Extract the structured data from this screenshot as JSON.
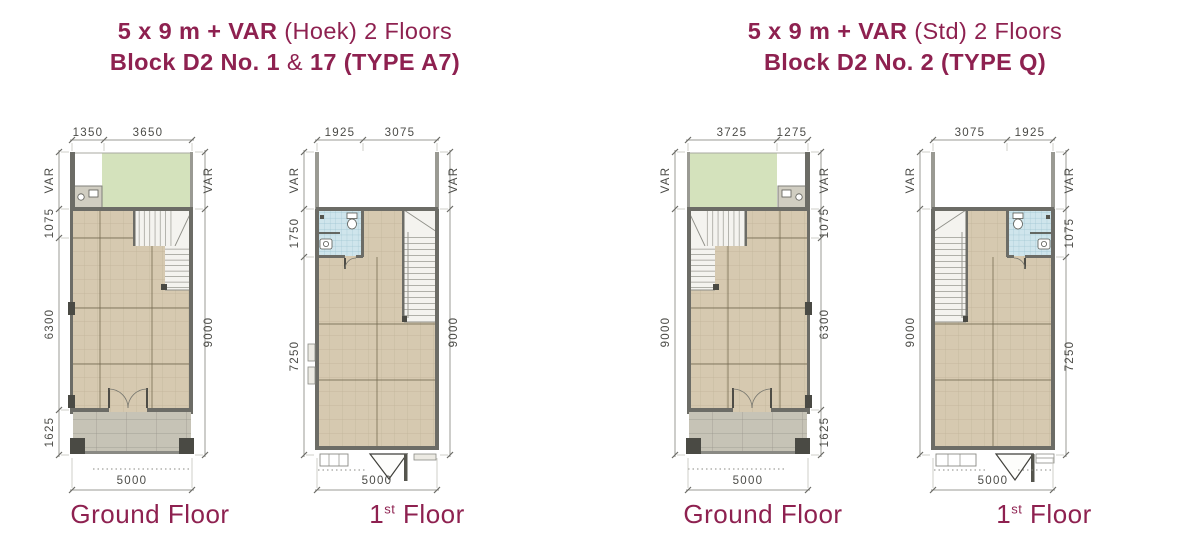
{
  "colors": {
    "accent_maroon": "#8e2150",
    "dim_text": "#4b4b47",
    "dim_line": "#9b9b95",
    "garden_green": "#d4e2bc",
    "floor_tan": "#d6c9b0",
    "porch_gray": "#c6c3b6",
    "wall_dark": "#6c6c66",
    "bath_blue": "#cfe5ec",
    "stair_white": "#f4f3ef"
  },
  "titles": [
    {
      "line1_bold": "5 x 9 m + VAR",
      "line1_regular": " (Hoek) 2 Floors",
      "line2_part1": "Block D2 No. 1",
      "line2_amp": " & ",
      "line2_part2": "17 (TYPE A7)"
    },
    {
      "line1_bold": "5 x 9 m + VAR",
      "line1_regular": " (Std) 2 Floors",
      "line2": "Block D2 No. 2 (TYPE Q)"
    }
  ],
  "plans": [
    {
      "label": "Ground Floor",
      "top_dims": [
        "1350",
        "3650"
      ],
      "left_dims": [
        "VAR",
        "1075",
        "6300",
        "1625"
      ],
      "right_dims": [
        "VAR",
        "9000"
      ],
      "bottom_dim": "5000"
    },
    {
      "label_num": "1",
      "label_sup": "st",
      "label_rest": " Floor",
      "top_dims": [
        "1925",
        "3075"
      ],
      "left_dims": [
        "VAR",
        "1750",
        "7250"
      ],
      "right_dims": [
        "VAR",
        "9000"
      ],
      "bottom_dim": "5000"
    },
    {
      "label": "Ground Floor",
      "top_dims": [
        "3725",
        "1275"
      ],
      "left_dims": [
        "VAR",
        "9000"
      ],
      "right_dims": [
        "VAR",
        "1075",
        "6300",
        "1625"
      ],
      "bottom_dim": "5000"
    },
    {
      "label_num": "1",
      "label_sup": "st",
      "label_rest": " Floor",
      "top_dims": [
        "3075",
        "1925"
      ],
      "left_dims": [
        "VAR",
        "9000"
      ],
      "right_dims": [
        "VAR",
        "1075",
        "7250"
      ],
      "bottom_dim": "5000"
    }
  ]
}
